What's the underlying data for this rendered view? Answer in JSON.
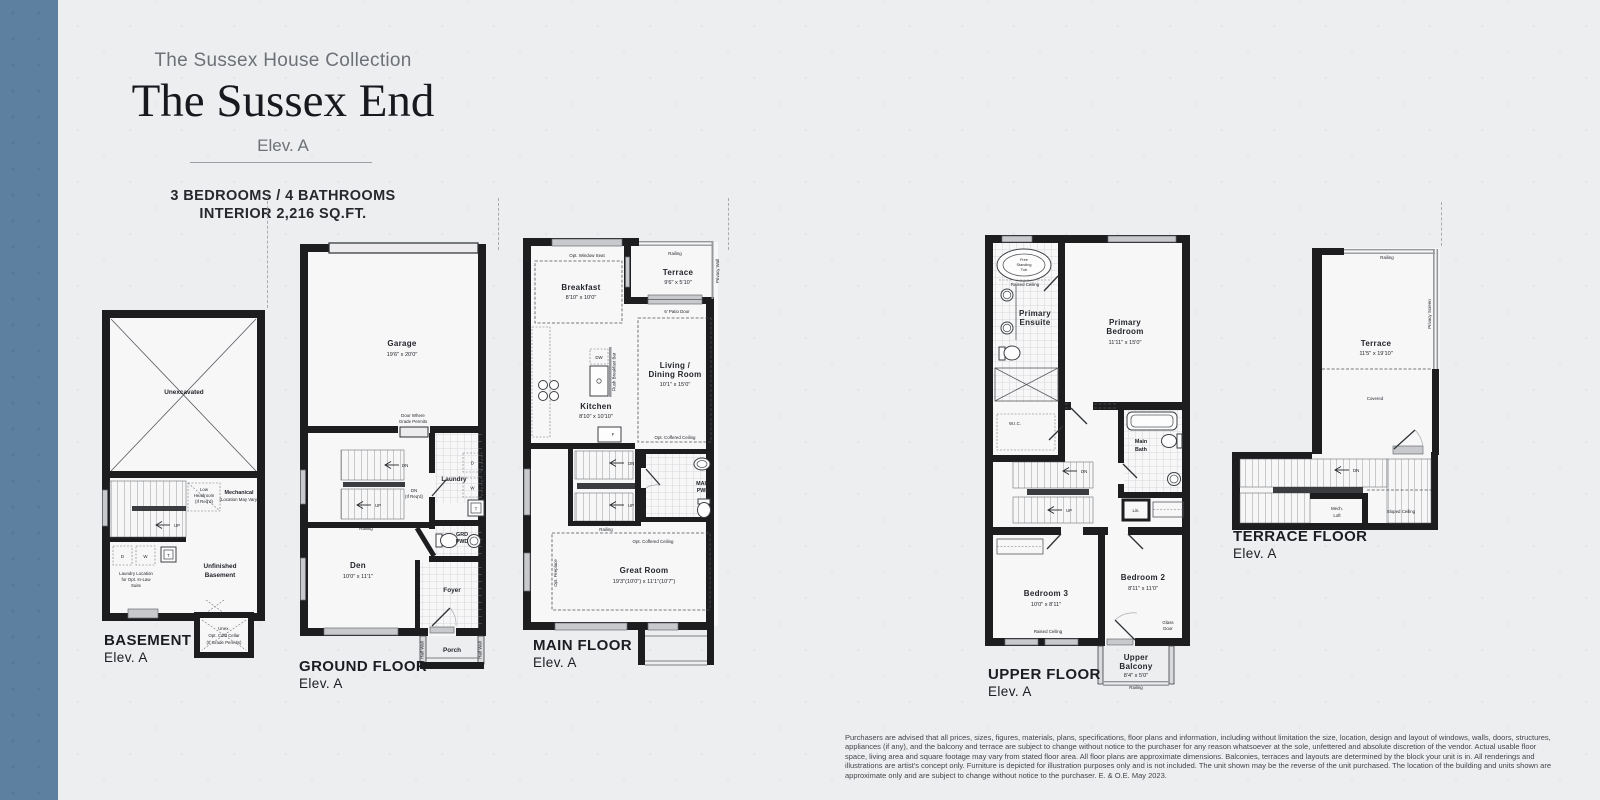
{
  "header": {
    "collection": "The Sussex House Collection",
    "title": "The Sussex End",
    "elevation": "Elev. A",
    "specs1": "3 BEDROOMS / 4 BATHROOMS",
    "specs2": "INTERIOR 2,216 SQ.FT."
  },
  "plans": {
    "basement": {
      "title": "BASEMENT",
      "elev": "Elev. A",
      "unexcavated": "Unexcavated",
      "low1": "Low",
      "low2": "Headroom",
      "low3": "(If Req'd)",
      "mech1": "Mechanical",
      "mech2": "(Location May Vary)",
      "up": "UP",
      "d": "D",
      "w": "W",
      "t": "T",
      "laundry1": "Laundry Location",
      "laundry2": "for Opt. In-Law",
      "laundry3": "Suite",
      "unf1": "Unfinished",
      "unf2": "Basement",
      "cc1": "Unex.",
      "cc2": "Opt. Cold Cellar",
      "cc3": "(If Grade Permits)"
    },
    "ground": {
      "title": "GROUND FLOOR",
      "elev": "Elev. A",
      "garage": "Garage",
      "garage_dim": "19'6\" x 20'0\"",
      "door1": "Door Where",
      "door2": "Grade Permits",
      "dn": "DN",
      "dnr1": "DN",
      "dnr2": "(If Req'd)",
      "up": "UP",
      "railing": "Railing",
      "laundry": "Laundry",
      "d": "D",
      "w": "W",
      "t": "T",
      "opt_uppers": "Opt. Uppers",
      "grd1": "GRD",
      "grd2": "PWD",
      "den": "Den",
      "den_dim": "10'0\" x 11'1\"",
      "foyer": "Foyer",
      "porch": "Porch",
      "half_wall": "Half Wall"
    },
    "main": {
      "title": "MAIN FLOOR",
      "elev": "Elev. A",
      "window_seat": "Opt. Window Seat",
      "breakfast": "Breakfast",
      "breakfast_dim": "8'10\" x 10'0\"",
      "railing": "Railing",
      "terrace": "Terrace",
      "terrace_dim": "9'6\" x 5'10\"",
      "privacy_wall": "Privacy Wall",
      "patio_door": "6' Patio Door",
      "living1": "Living /",
      "living2": "Dining Room",
      "living_dim": "10'1\" x 15'0\"",
      "dw": "DW",
      "flush_bar": "Flush Breakfast Bar",
      "kitchen": "Kitchen",
      "kitchen_dim": "8'10\" x 10'10\"",
      "f": "F",
      "coffered": "Opt. Coffered Ceiling",
      "dn": "DN",
      "up": "UP",
      "pwd1": "MAIN",
      "pwd2": "PWD",
      "great": "Great Room",
      "great_dim": "19'3\"(10'0\") x 11'1\"(10'7\")",
      "fireplace": "Opt. Fireplace"
    },
    "upper": {
      "title": "UPPER FLOOR",
      "elev": "Elev. A",
      "tub1": "Free",
      "tub2": "Standing",
      "tub3": "Tub",
      "raised": "Raised Ceiling",
      "ensuite1": "Primary",
      "ensuite2": "Ensuite",
      "bed1a": "Primary",
      "bed1b": "Bedroom",
      "bed1_dim": "11'11\" x 15'0\"",
      "wic": "W.I.C.",
      "bath1": "Main",
      "bath2": "Bath",
      "lin": "Lin.",
      "dn": "DN",
      "up": "UP",
      "bed3": "Bedroom 3",
      "bed3_dim": "10'0\" x 8'11\"",
      "bed2": "Bedroom 2",
      "bed2_dim": "8'11\" x 11'0\"",
      "glass1": "Glass",
      "glass2": "Door",
      "balc1": "Upper",
      "balc2": "Balcony",
      "balc_dim": "8'4\" x 5'0\"",
      "railing": "Railing"
    },
    "terrace": {
      "title": "TERRACE FLOOR",
      "elev": "Elev. A",
      "railing": "Railing",
      "privacy": "Privacy Screen",
      "terrace": "Terrace",
      "terrace_dim": "11'5\" x 19'10\"",
      "covered": "Covered",
      "dn": "DN",
      "mech1": "Mech.",
      "mech2": "Loft",
      "sloped": "Sloped Ceiling"
    }
  },
  "disclaimer": "Purchasers are advised that all prices, sizes, figures, materials, plans, specifications, floor plans and information, including without limitation the size, location, design and layout of windows, walls, doors, structures, appliances (if any), and the balcony and terrace are subject to change without notice to the purchaser for any reason whatsoever at the sole, unfettered and absolute discretion of the vendor. Actual usable floor space, living area and square footage may vary from stated floor area. All floor plans are approximate dimensions. Balconies, terraces and layouts are determined by the block your unit is in. All renderings and illustrations are artist's concept only. Furniture is depicted for illustration purposes only and is not included. The unit shown may be the reverse of the unit purchased. The location of the building and units shown are approximate only and are subject to change without notice to the purchaser. E. & O.E. May 2023."
}
